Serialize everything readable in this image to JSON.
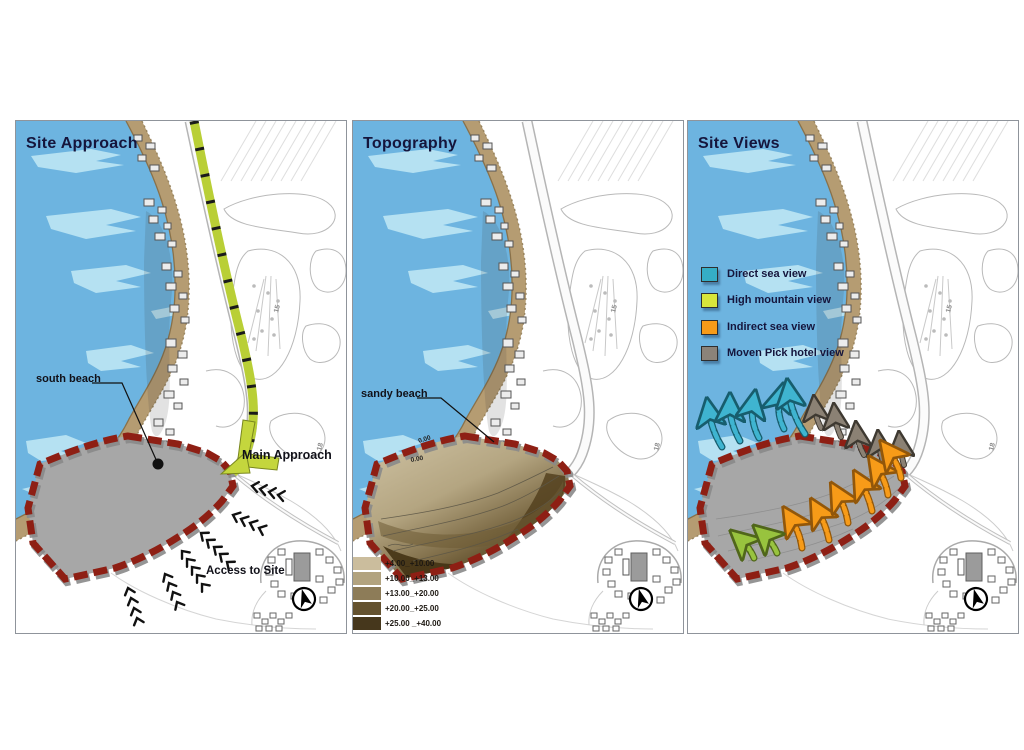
{
  "panels": {
    "approach": {
      "title": "Site Approach",
      "south_beach_label": "south beach",
      "main_approach_label": "Main Approach",
      "access_label": "Access to Site"
    },
    "topography": {
      "title": "Topography",
      "sandy_beach_label": "sandy beach",
      "contour_labels": [
        "0.00",
        "0.00"
      ],
      "legend": [
        {
          "range": "+4.00_+10.00",
          "color": "#cbbd9d"
        },
        {
          "range": "+10.00_+13.00",
          "color": "#b2a37f"
        },
        {
          "range": "+13.00_+20.00",
          "color": "#8d7c58"
        },
        {
          "range": "+20.00_+25.00",
          "color": "#64522f"
        },
        {
          "range": "+25.00 _+40.00",
          "color": "#46371c"
        }
      ]
    },
    "views": {
      "title": "Site Views",
      "legend": [
        {
          "label": "Direct sea view",
          "color": "#35aec6"
        },
        {
          "label": "High mountain view",
          "color": "#d9e63b"
        },
        {
          "label": "Indirect sea view",
          "color": "#f79b18"
        },
        {
          "label": "Moven Pick hotel view",
          "color": "#8b8379"
        }
      ]
    }
  },
  "base_map": {
    "hole_numbers": [
      "15",
      "18"
    ],
    "compass_icon": "north-arrow"
  },
  "colors": {
    "water": "#6db4e0",
    "water_highlight": "#b9e4f3",
    "sand": "#b59c72",
    "site_fill": "#a7a7a7",
    "boundary_red": "#8e1f14",
    "approach_green": "#c0d438"
  }
}
